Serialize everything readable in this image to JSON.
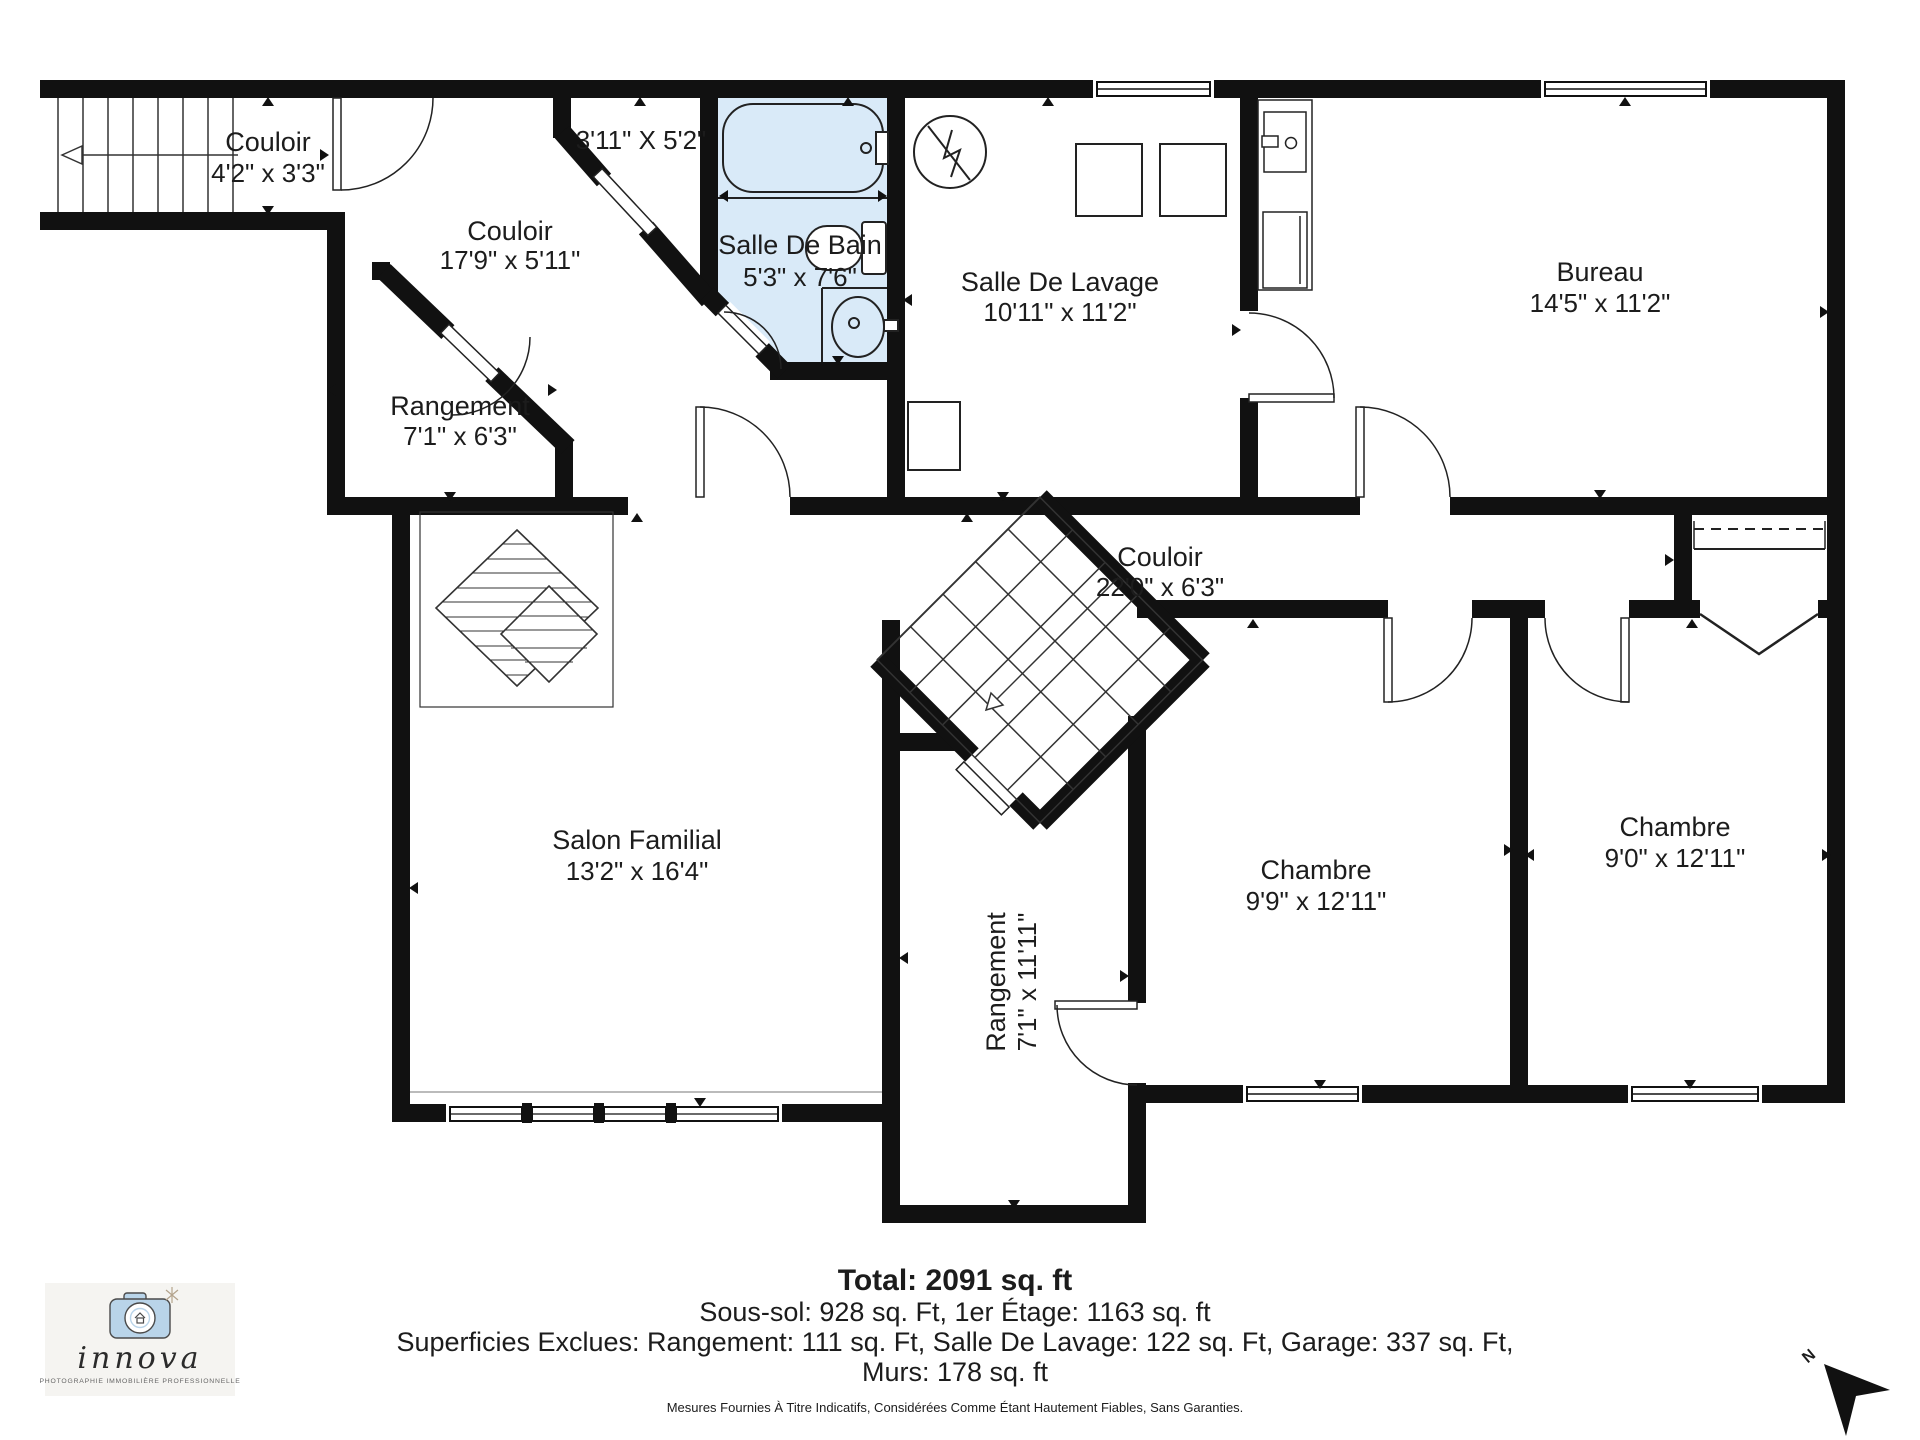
{
  "colors": {
    "wall": "#111111",
    "bathroom_fill": "#d9eaf8",
    "line": "#2a2a2a",
    "logo_bg": "#f5f4f1",
    "logo_camera": "#b9d4e9"
  },
  "rooms": {
    "couloir_stairs": {
      "name": "Couloir",
      "dims": "4'2\" x 3'3\""
    },
    "closet": {
      "dims": "3'11\" X 5'2\""
    },
    "couloir_diag": {
      "name": "Couloir",
      "dims": "17'9\" x 5'11\""
    },
    "salle_de_bain": {
      "name": "Salle De Bain",
      "dims": "5'3\" x 7'6\""
    },
    "salle_de_lavage": {
      "name": "Salle De Lavage",
      "dims": "10'11\" x 11'2\""
    },
    "bureau": {
      "name": "Bureau",
      "dims": "14'5\" x 11'2\""
    },
    "rangement_haut": {
      "name": "Rangement",
      "dims": "7'1\" x 6'3\""
    },
    "couloir_principal": {
      "name": "Couloir",
      "dims": "22'0\" x 6'3\""
    },
    "salon_familial": {
      "name": "Salon Familial",
      "dims": "13'2\" x 16'4\""
    },
    "rangement_bas": {
      "name": "Rangement",
      "dims": "7'1\" x 11'11\""
    },
    "chambre_1": {
      "name": "Chambre",
      "dims": "9'9\" x 12'11\""
    },
    "chambre_2": {
      "name": "Chambre",
      "dims": "9'0\" x 12'11\""
    }
  },
  "summary": {
    "total": "Total: 2091 sq. ft",
    "line2": "Sous-sol: 928 sq. Ft, 1er Étage: 1163 sq. ft",
    "line3": "Superficies Exclues: Rangement: 111 sq. Ft, Salle De Lavage: 122 sq. Ft, Garage: 337 sq. Ft,",
    "line4": "Murs: 178 sq. ft",
    "disclaimer": "Mesures Fournies À Titre Indicatifs, Considérées Comme Étant Hautement Fiables, Sans Garanties."
  },
  "logo": {
    "brand": "innova",
    "tagline": "PHOTOGRAPHIE IMMOBILIÈRE PROFESSIONNELLE"
  },
  "compass": {
    "north_label": "N"
  }
}
